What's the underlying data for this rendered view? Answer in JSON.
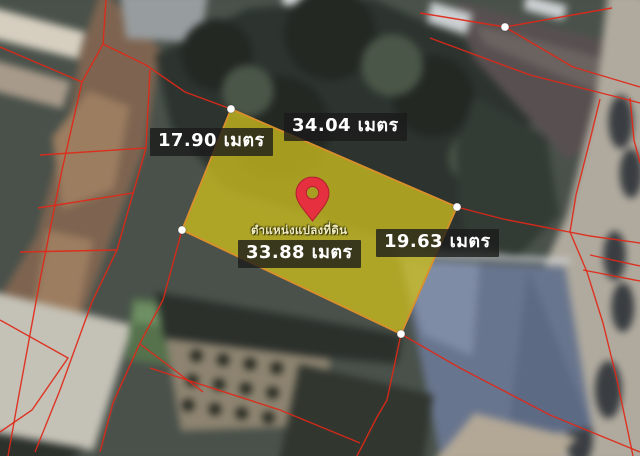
{
  "plot": {
    "points_str": "231,109 457,207 401,334 182,230",
    "fill": "#cbbd1e",
    "border": "#d98f2b",
    "caption": "ตำแหน่งแปลงที่ดิน"
  },
  "measurements": {
    "top": {
      "label": "34.04 เมตร",
      "value_m": 34.04
    },
    "left": {
      "label": "17.90 เมตร",
      "value_m": 17.9
    },
    "right": {
      "label": "19.63 เมตร",
      "value_m": 19.63
    },
    "bottom": {
      "label": "33.88 เมตร",
      "value_m": 33.88
    }
  },
  "colors": {
    "boundary_line": "#e02818",
    "label_bg": "rgba(26,26,26,0.78)",
    "label_text": "#ffffff",
    "caption_text": "#f2ecc0",
    "pin": "#e6303f",
    "pin_stroke": "#b01f2e",
    "vertex_dot": "#ffffff"
  }
}
